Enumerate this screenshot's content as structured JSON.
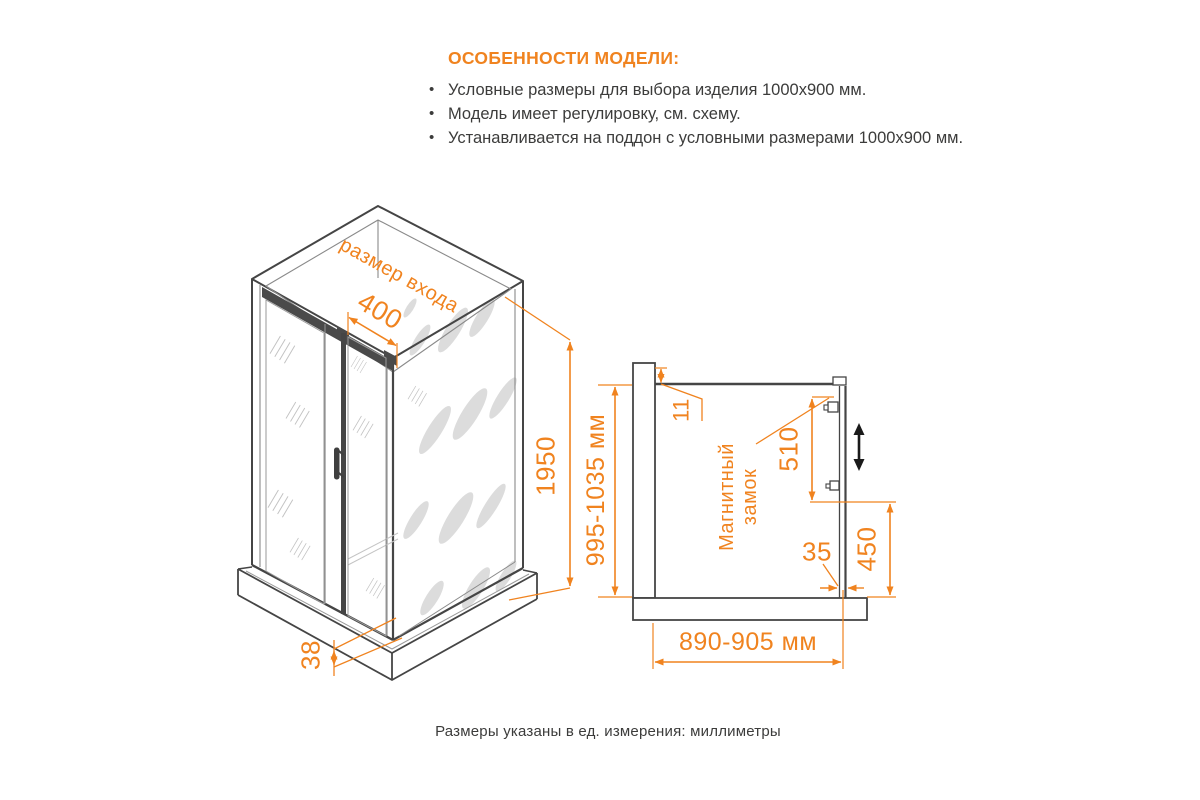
{
  "features": {
    "title": "ОСОБЕННОСТИ МОДЕЛИ:",
    "bullet": "•",
    "items": [
      "Условные размеры для выбора изделия 1000x900 мм.",
      "Модель имеет регулировку, см. схему.",
      "Устанавливается на поддон с условными размерами 1000x900 мм."
    ]
  },
  "iso_view": {
    "entrance_label": "размер входа",
    "entrance_width": "400",
    "height": "1950",
    "base_height": "38"
  },
  "plan_view": {
    "profile_gap": "11",
    "depth_range": "995-1035 мм",
    "magnetic_lock_line1": "Магнитный",
    "magnetic_lock_line2": "замок",
    "lock_span": "510",
    "bottom_gap": "35",
    "fixed_panel": "450",
    "width_range": "890-905 мм"
  },
  "footer": {
    "note": "Размеры указаны в ед. измерения: миллиметры"
  },
  "colors": {
    "accent": "#F0831F",
    "text": "#3C3C3B",
    "line": "#454545"
  }
}
